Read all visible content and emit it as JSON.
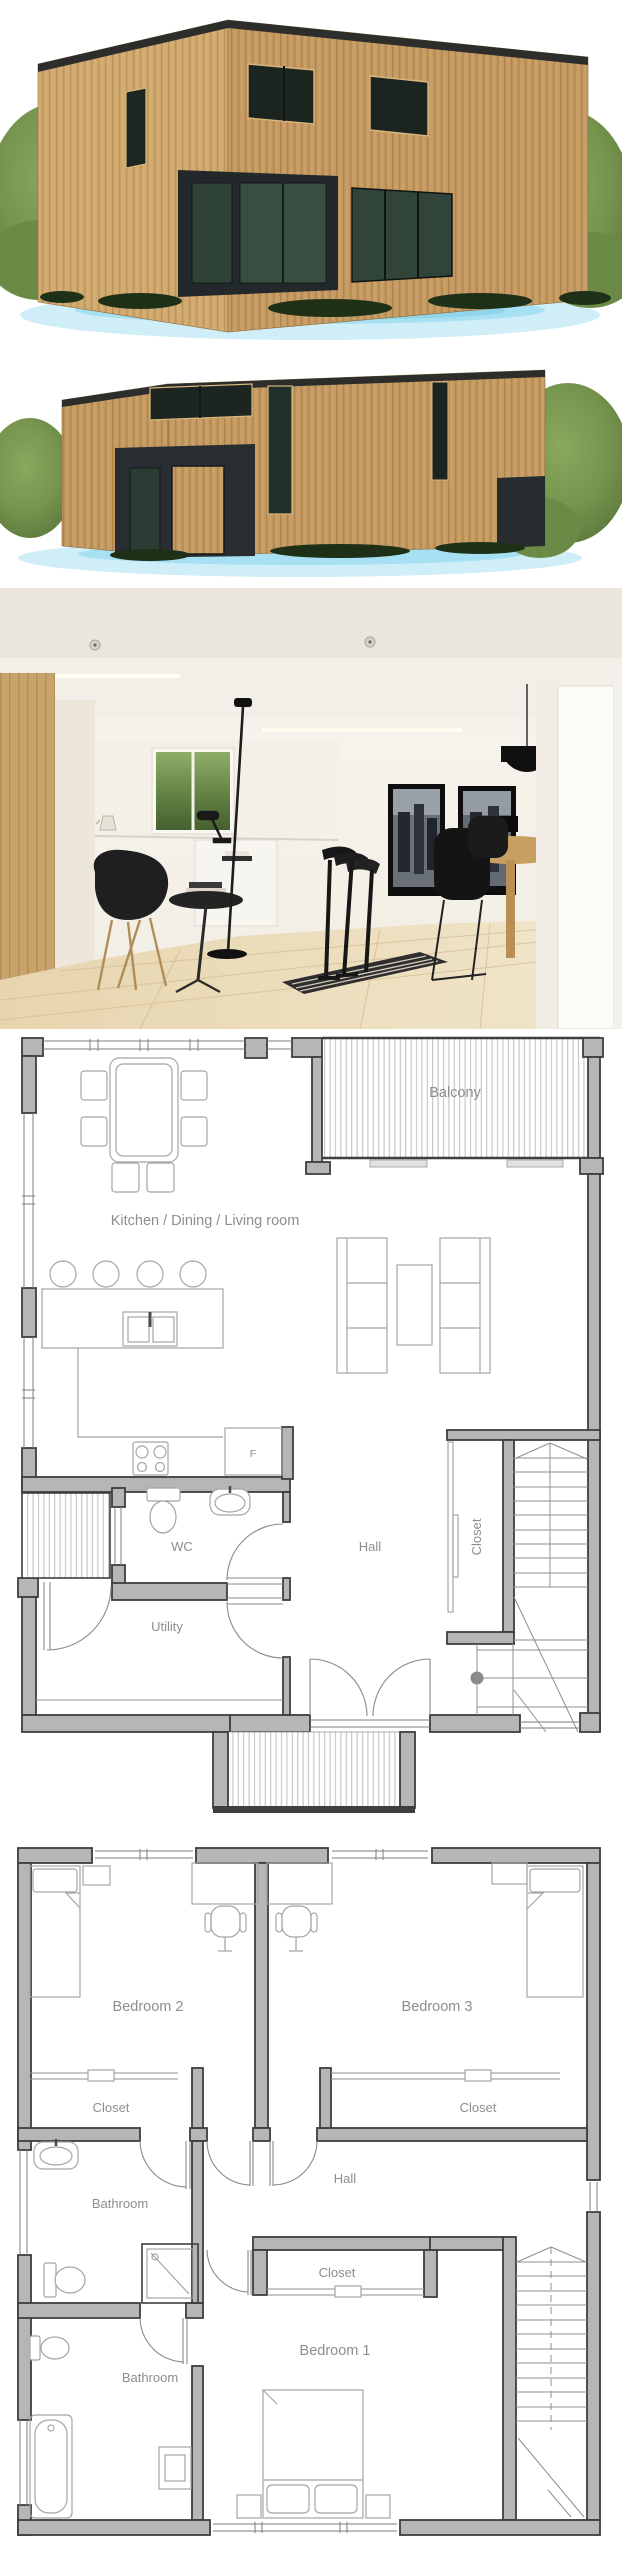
{
  "page": {
    "title": "House plan with two floors"
  },
  "colors": {
    "wall_fill": "#b6b6b6",
    "wall_stroke": "#3e3e3e",
    "furniture_line": "#a5a5a5",
    "label_text": "#8e8e8e",
    "wood_facade": "#c49a62",
    "dark_trim": "#272d31",
    "foliage": "#75944d",
    "ground_shadow": "#bfe7f4"
  },
  "renders": {
    "exterior_front": {
      "name": "wooden cube house, front-left view"
    },
    "exterior_entrance": {
      "name": "wooden cube house, entrance view"
    },
    "interior": {
      "name": "kitchen / dining / living room interior"
    }
  },
  "floor_plan_1": {
    "name": "first floor plan",
    "labels": {
      "balcony": "Balcony",
      "main_room": "Kitchen / Dining / Living room",
      "wc": "WC",
      "hall": "Hall",
      "closet": "Closet",
      "utility": "Utility",
      "fridge": "F"
    }
  },
  "floor_plan_2": {
    "name": "second floor plan",
    "labels": {
      "bedroom2": "Bedroom 2",
      "bedroom3": "Bedroom 3",
      "closet_bedroom2": "Closet",
      "closet_bedroom3": "Closet",
      "bathroom_upper": "Bathroom",
      "hall": "Hall",
      "closet_hall": "Closet",
      "bathroom_lower": "Bathroom",
      "bedroom1": "Bedroom 1"
    }
  }
}
